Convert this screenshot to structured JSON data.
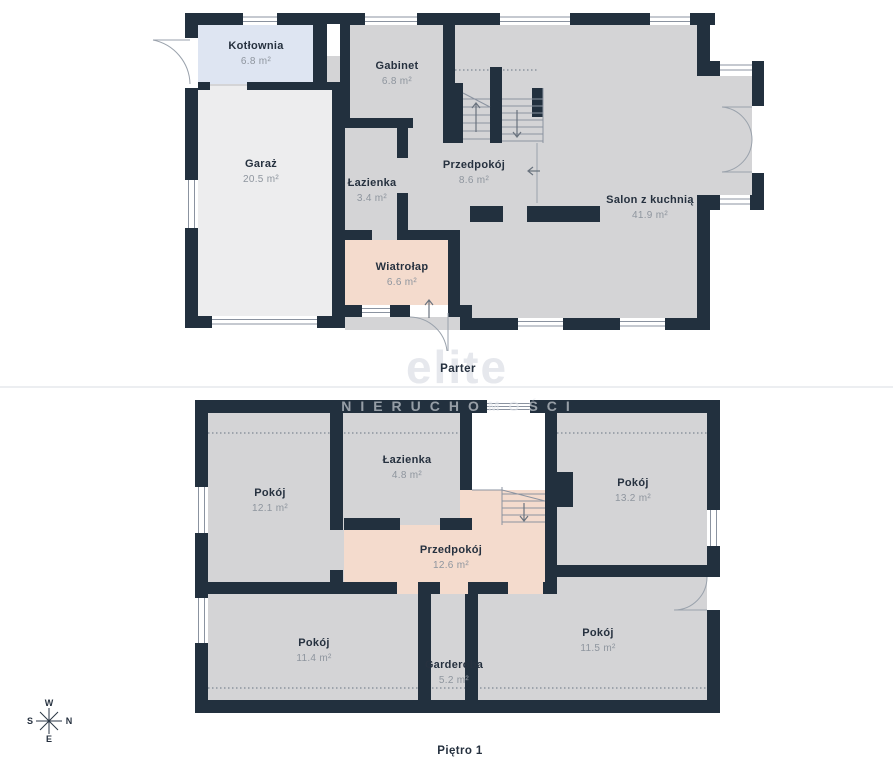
{
  "floors": [
    {
      "label": "Parter",
      "rooms": [
        {
          "name": "Kotłownia",
          "area": "6.8 m²"
        },
        {
          "name": "Garaż",
          "area": "20.5 m²"
        },
        {
          "name": "Gabinet",
          "area": "6.8 m²"
        },
        {
          "name": "Łazienka",
          "area": "3.4 m²"
        },
        {
          "name": "Przedpokój",
          "area": "8.6 m²"
        },
        {
          "name": "Salon z kuchnią",
          "area": "41.9 m²"
        },
        {
          "name": "Wiatrołap",
          "area": "6.6 m²"
        }
      ]
    },
    {
      "label": "Piętro 1",
      "rooms": [
        {
          "name": "Pokój",
          "area": "12.1 m²"
        },
        {
          "name": "Łazienka",
          "area": "4.8 m²"
        },
        {
          "name": "Pokój",
          "area": "13.2 m²"
        },
        {
          "name": "Przedpokój",
          "area": "12.6 m²"
        },
        {
          "name": "Pokój",
          "area": "11.4 m²"
        },
        {
          "name": "Garderoba",
          "area": "5.2 m²"
        },
        {
          "name": "Pokój",
          "area": "11.5 m²"
        }
      ]
    }
  ],
  "watermark": {
    "brand": "elite",
    "subtitle": "NIERUCHOMOŚCI"
  },
  "compass": {
    "top": "W",
    "right": "N",
    "bottom": "E",
    "left": "S"
  },
  "colors": {
    "wall": "#22303e",
    "room_gray": "#d4d4d6",
    "garage_floor": "#ededee",
    "boiler_blue": "#dee5f2",
    "hall_salmon": "#f4dbcd",
    "stairwell_white": "#ffffff",
    "thin_line": "#9aa2ac",
    "dotted_line": "#7e8893",
    "label_text": "#26313f",
    "label_muted": "#8e959e"
  }
}
